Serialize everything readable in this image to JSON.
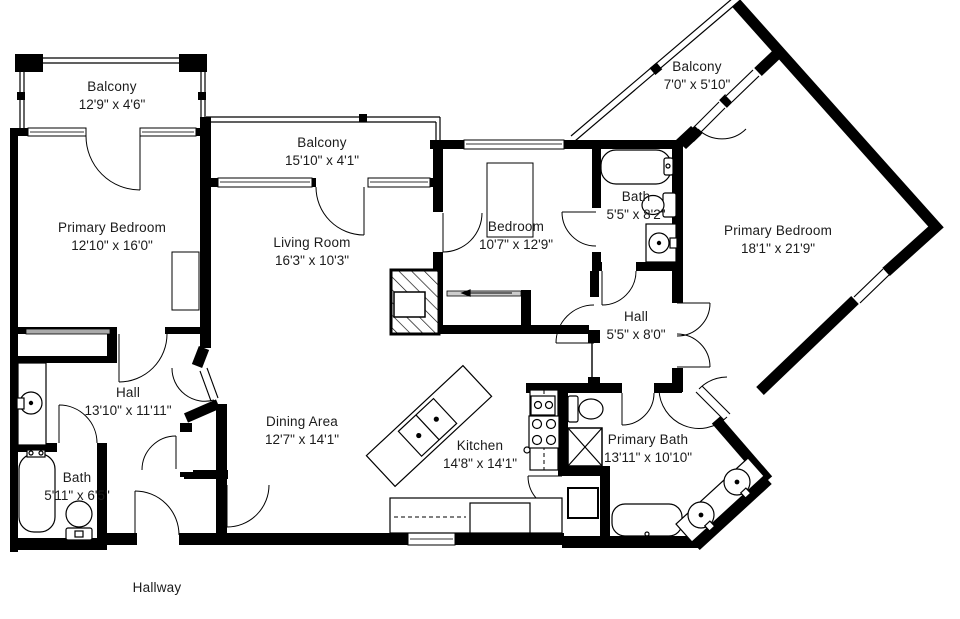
{
  "page": {
    "background": "#ffffff",
    "wall_color": "#000000",
    "label_color": "#1b1b1b"
  },
  "floorplan": {
    "rooms": [
      {
        "id": "balcony-top-left",
        "name": "Balcony",
        "dims": "12'9\" x 4'6\"",
        "x": 112,
        "y": 96
      },
      {
        "id": "balcony-middle",
        "name": "Balcony",
        "dims": "15'10\" x 4'1\"",
        "x": 322,
        "y": 152
      },
      {
        "id": "balcony-right",
        "name": "Balcony",
        "dims": "7'0\" x 5'10\"",
        "x": 697,
        "y": 76
      },
      {
        "id": "primary-bedroom-left",
        "name": "Primary Bedroom",
        "dims": "12'10\" x 16'0\"",
        "x": 112,
        "y": 237
      },
      {
        "id": "living-room",
        "name": "Living Room",
        "dims": "16'3\" x 10'3\"",
        "x": 312,
        "y": 252
      },
      {
        "id": "bedroom",
        "name": "Bedroom",
        "dims": "10'7\" x 12'9\"",
        "x": 516,
        "y": 236
      },
      {
        "id": "bath-upper",
        "name": "Bath",
        "dims": "5'5\" x 8'2\"",
        "x": 636,
        "y": 206
      },
      {
        "id": "primary-bedroom-right",
        "name": "Primary Bedroom",
        "dims": "18'1\" x 21'9\"",
        "x": 778,
        "y": 240
      },
      {
        "id": "hall-right",
        "name": "Hall",
        "dims": "5'5\" x 8'0\"",
        "x": 636,
        "y": 326
      },
      {
        "id": "hall-left",
        "name": "Hall",
        "dims": "13'10\" x 11'11\"",
        "x": 128,
        "y": 402
      },
      {
        "id": "dining-area",
        "name": "Dining Area",
        "dims": "12'7\" x 14'1\"",
        "x": 302,
        "y": 431
      },
      {
        "id": "kitchen",
        "name": "Kitchen",
        "dims": "14'8\" x 14'1\"",
        "x": 480,
        "y": 455
      },
      {
        "id": "primary-bath",
        "name": "Primary Bath",
        "dims": "13'11\" x 10'10\"",
        "x": 648,
        "y": 449
      },
      {
        "id": "bath-lower",
        "name": "Bath",
        "dims": "5'11\" x 6'5\"",
        "x": 77,
        "y": 487
      },
      {
        "id": "hallway",
        "name": "Hallway",
        "dims": "",
        "x": 157,
        "y": 588
      }
    ]
  }
}
